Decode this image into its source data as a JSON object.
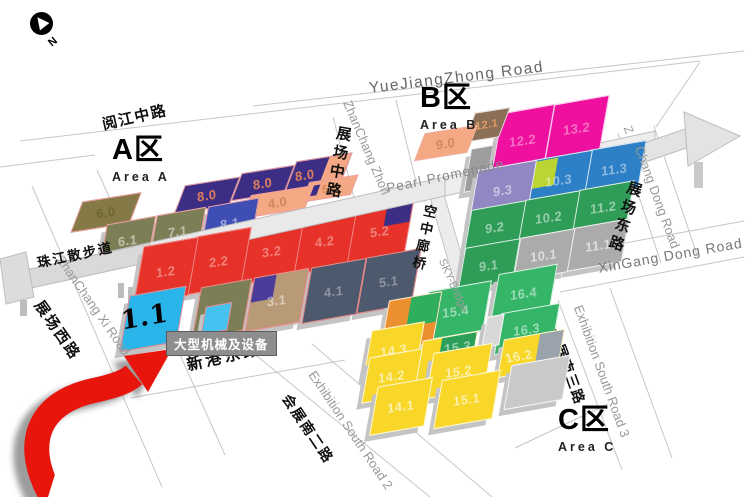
{
  "compass": {
    "label": "N"
  },
  "areas": {
    "a": {
      "title": "A区",
      "subtitle": "Area A"
    },
    "b": {
      "title": "B区",
      "subtitle": "Area B"
    },
    "c": {
      "title": "C区",
      "subtitle": "Area C"
    }
  },
  "callout": {
    "text": "大型机械及设备",
    "target_hall": "1.1"
  },
  "accent": {
    "arrow_color": "#e8150c",
    "arrow_shadow": "rgba(30,30,30,0.45)"
  },
  "roadLabels": [
    {
      "id": "yuejiangzhong-road-en",
      "text": "YueJiangZhong Road",
      "x": 368,
      "y": 80,
      "rot": -7,
      "cls": "en",
      "size": 15.5,
      "color": "#666",
      "ls": 1.5
    },
    {
      "id": "yuejiang-middle-road-cn",
      "text": "阅江中路",
      "x": 100,
      "y": 114,
      "rot": -13,
      "cls": "cn",
      "ls": 1.5
    },
    {
      "id": "zhanchang-zhong-road-en",
      "text": "ZhanChang Zhon",
      "x": 354,
      "y": 98,
      "rot": 67,
      "cls": "en",
      "size": 13
    },
    {
      "id": "zhanchang-zhong-road-cn",
      "text": "展场中路",
      "x": 334,
      "y": 124,
      "rot": 10,
      "cls": "cnv"
    },
    {
      "id": "pearl-promenade-en",
      "text": "Pearl Promenade",
      "x": 385,
      "y": 181,
      "rot": -12,
      "cls": "en",
      "size": 13.5,
      "color": "#888",
      "ls": 1
    },
    {
      "id": "zhujiang-promenade-cn",
      "text": "珠江散步道",
      "x": 35,
      "y": 252,
      "rot": -12,
      "cls": "cn",
      "size": 13.5,
      "ls": 2,
      "z": 330
    },
    {
      "id": "sky-corridor-cn",
      "text": "空中廊桥",
      "x": 420,
      "y": 202,
      "rot": 12,
      "cls": "cnv",
      "size": 13.5
    },
    {
      "id": "sky-bridge-en",
      "text": "SKY-Bridge",
      "x": 447,
      "y": 257,
      "rot": 66,
      "cls": "en",
      "size": 11,
      "color": "#9a9a9a"
    },
    {
      "id": "z-fragment",
      "text": "Z",
      "x": 634,
      "y": 124,
      "rot": 70,
      "cls": "en",
      "size": 12
    },
    {
      "id": "chang-dong-road-en",
      "text": "Chang Dong Road",
      "x": 646,
      "y": 144,
      "rot": 70,
      "cls": "en",
      "size": 13
    },
    {
      "id": "zhanchang-dong-road-cn",
      "text": "展场东路",
      "x": 626,
      "y": 178,
      "rot": 18,
      "cls": "cnv"
    },
    {
      "id": "xingang-dong-road-en",
      "text": "XinGang Dong Road",
      "x": 597,
      "y": 260,
      "rot": -10,
      "cls": "en",
      "size": 14,
      "color": "#777",
      "ls": 1
    },
    {
      "id": "xingang-dong-road-cn",
      "text": "新港东路",
      "x": 184,
      "y": 352,
      "rot": -13,
      "cls": "cn",
      "size": 16,
      "ls": 3
    },
    {
      "id": "exhibition-south-road-2-en",
      "text": "Exhibition South Road 2",
      "x": 318,
      "y": 368,
      "rot": 56,
      "cls": "en",
      "size": 13
    },
    {
      "id": "exhibition-south-road-2-cn",
      "text": "会展南二路",
      "x": 294,
      "y": 390,
      "rot": 56,
      "cls": "cn",
      "size": 14,
      "ls": 2
    },
    {
      "id": "exhibition-south-road-3-en",
      "text": "Exhibition South Road 3",
      "x": 585,
      "y": 303,
      "rot": 70,
      "cls": "en",
      "size": 13
    },
    {
      "id": "exhibition-south-road-3-cn",
      "text": "会展南三路",
      "x": 563,
      "y": 326,
      "rot": 70,
      "cls": "cn",
      "size": 14,
      "ls": 2
    },
    {
      "id": "zhanchang-xi-road-en",
      "text": "ZhanChang Xi Road",
      "x": 66,
      "y": 253,
      "rot": 55,
      "cls": "en",
      "size": 13
    },
    {
      "id": "zhanchang-xi-road-cn",
      "text": "展场西路",
      "x": 47,
      "y": 296,
      "rot": 55,
      "cls": "cn",
      "ls": 2
    }
  ],
  "halls": [
    {
      "label": "6.0",
      "x": 76,
      "y": 198,
      "w": 58,
      "h": 27,
      "flat": true,
      "color": "#857a47",
      "text": "#6e6535",
      "border": "#f0a0a0"
    },
    {
      "label": "8.0",
      "x": 179,
      "y": 182,
      "w": 54,
      "h": 25,
      "flat": true,
      "color": "#3d2e85",
      "text": "#df7e5e",
      "border": "#f0a0a0"
    },
    {
      "label": "8.0",
      "x": 236,
      "y": 170,
      "w": 52,
      "h": 24,
      "flat": true,
      "color": "#3d2e85",
      "text": "#df7e5e",
      "border": "#f0a0a0"
    },
    {
      "label": "8.0",
      "x": 290,
      "y": 158,
      "w": 55,
      "h": 27,
      "flat": true,
      "color": "#3d2e85",
      "text": "#df7e5e",
      "border": "#f0a0a0",
      "labelPos": "l",
      "inner": {
        "x": "60%",
        "y": "0%",
        "w": "40%",
        "h": "100%",
        "color": "#f4a984"
      }
    },
    {
      "label": "4.0",
      "x": 246,
      "y": 191,
      "w": 62,
      "h": 20,
      "flat": true,
      "color": "#f4a984",
      "text": "#d3875c",
      "border": "#f0a0a0"
    },
    {
      "label": "5.0",
      "x": 305,
      "y": 179,
      "w": 48,
      "h": 17,
      "flat": true,
      "color": "#f4a984",
      "text": "#d3875c",
      "border": "#f0a0a0",
      "labelSize": 11,
      "inner": {
        "x": "8%",
        "y": "18%",
        "w": "16%",
        "h": "58%",
        "color": "#3d2e85"
      }
    },
    {
      "label": "6.1",
      "x": 103,
      "y": 221,
      "w": 48,
      "h": 36,
      "color": "#7c7f55",
      "border": "#f0a0a0"
    },
    {
      "label": "7.1",
      "x": 153,
      "y": 212,
      "w": 48,
      "h": 36,
      "color": "#7c7f55",
      "border": "#f0a0a0"
    },
    {
      "label": "8.1",
      "x": 204,
      "y": 203,
      "w": 50,
      "h": 38,
      "color": "#3f4eb5",
      "border": "#f0a0a0"
    },
    {
      "label": "1.2",
      "x": 138,
      "y": 243,
      "w": 54,
      "h": 54,
      "color": "#e63229",
      "text": "rgba(255,255,255,0.38)",
      "border": "#f08a8a"
    },
    {
      "label": "2.2",
      "x": 191,
      "y": 233,
      "w": 54,
      "h": 54,
      "color": "#e63229",
      "text": "rgba(255,255,255,0.38)",
      "border": "#f08a8a"
    },
    {
      "label": "3.2",
      "x": 244,
      "y": 223,
      "w": 54,
      "h": 54,
      "color": "#e63229",
      "text": "rgba(255,255,255,0.38)",
      "border": "#f08a8a"
    },
    {
      "label": "4.2",
      "x": 297,
      "y": 213,
      "w": 54,
      "h": 54,
      "color": "#e63229",
      "text": "rgba(255,255,255,0.38)",
      "border": "#f08a8a"
    },
    {
      "label": "5.2",
      "x": 350,
      "y": 203,
      "w": 58,
      "h": 54,
      "color": "#e63229",
      "text": "rgba(255,255,255,0.38)",
      "border": "#f08a8a",
      "inner": {
        "x": "56%",
        "y": "0%",
        "w": "44%",
        "h": "42%",
        "color": "#3d2e85"
      }
    },
    {
      "label": "1.1",
      "x": 124,
      "y": 292,
      "w": 56,
      "h": 52,
      "color": "#2ab5ea",
      "border": "#f08a8a",
      "big": true
    },
    {
      "label": "",
      "x": 203,
      "y": 305,
      "w": 25,
      "h": 25,
      "color": "#45c2ef",
      "border": "#f08a8a"
    },
    {
      "label": "2.1",
      "x": 196,
      "y": 284,
      "w": 50,
      "h": 48,
      "color": "#7c7f55",
      "border": "#f08a8a"
    },
    {
      "label": "3.1",
      "x": 249,
      "y": 274,
      "w": 54,
      "h": 50,
      "color": "#b89b76",
      "border": "#f08a8a",
      "inner": {
        "x": "0%",
        "y": "0%",
        "w": "40%",
        "h": "46%",
        "color": "#4a3d99"
      }
    },
    {
      "label": "4.1",
      "x": 306,
      "y": 264,
      "w": 54,
      "h": 52,
      "color": "#4d5a6d",
      "text": "rgba(255,255,255,0.35)",
      "border": "#f08a8a"
    },
    {
      "label": "5.1",
      "x": 361,
      "y": 254,
      "w": 54,
      "h": 52,
      "color": "#4d5a6d",
      "text": "rgba(255,255,255,0.35)",
      "border": "#f08a8a"
    },
    {
      "label": "9.0",
      "x": 419,
      "y": 130,
      "w": 52,
      "h": 24,
      "flat": true,
      "color": "#f4a984",
      "text": "#d3875c",
      "border": "#f0b0a0"
    },
    {
      "label": "12.1",
      "x": 469,
      "y": 111,
      "w": 34,
      "h": 26,
      "flat": true,
      "color": "#8b6f56",
      "text": "#e09a62",
      "labelSize": 11
    },
    {
      "label": "",
      "x": 467,
      "y": 146,
      "w": 42,
      "h": 40,
      "color": "#9d9d9d",
      "z": 100
    },
    {
      "label": "12.2",
      "x": 496,
      "y": 110,
      "w": 52,
      "h": 58,
      "color": "#ef109f",
      "text": "rgba(255,255,255,0.4)"
    },
    {
      "label": "13.2",
      "x": 549,
      "y": 101,
      "w": 54,
      "h": 53,
      "color": "#ef109f",
      "text": "rgba(255,255,255,0.4)"
    },
    {
      "label": "9.3",
      "x": 473,
      "y": 166,
      "w": 58,
      "h": 47,
      "color": "#9187c2"
    },
    {
      "label": "10.3",
      "x": 529,
      "y": 156,
      "w": 58,
      "h": 46,
      "color": "#2e80c6",
      "text": "rgba(255,255,255,0.45)",
      "inner": {
        "x": "3%",
        "y": "3%",
        "w": "38%",
        "h": "55%",
        "color": "#bcd532"
      }
    },
    {
      "label": "11.3",
      "x": 585,
      "y": 146,
      "w": 56,
      "h": 44,
      "color": "#2e80c6",
      "text": "rgba(255,255,255,0.45)"
    },
    {
      "label": "9.2",
      "x": 467,
      "y": 206,
      "w": 54,
      "h": 41,
      "color": "#2f9c58"
    },
    {
      "label": "10.2",
      "x": 521,
      "y": 196,
      "w": 54,
      "h": 41,
      "color": "#2f9c58"
    },
    {
      "label": "11.2",
      "x": 575,
      "y": 186,
      "w": 54,
      "h": 41,
      "color": "#2f9c58"
    },
    {
      "label": "9.1",
      "x": 461,
      "y": 244,
      "w": 54,
      "h": 40,
      "color": "#2f9c58"
    },
    {
      "label": "10.1",
      "x": 516,
      "y": 234,
      "w": 54,
      "h": 40,
      "color": "#ababab",
      "text": "rgba(255,255,255,0.6)"
    },
    {
      "label": "11.1",
      "x": 570,
      "y": 224,
      "w": 54,
      "h": 40,
      "color": "#ababab",
      "text": "rgba(255,255,255,0.6)"
    },
    {
      "label": "14.4",
      "x": 384,
      "y": 297,
      "w": 52,
      "h": 48,
      "color": "#ec8f2e",
      "labelPos": "bl",
      "inner": {
        "x": "42%",
        "y": "0%",
        "w": "58%",
        "h": "58%",
        "color": "#2fae5e"
      }
    },
    {
      "label": "15.4",
      "x": 424,
      "y": 287,
      "w": 62,
      "h": 46,
      "color": "#35b568"
    },
    {
      "label": "16.4",
      "x": 494,
      "y": 270,
      "w": 58,
      "h": 44,
      "color": "#35b568"
    },
    {
      "label": "14.3",
      "x": 367,
      "y": 327,
      "w": 52,
      "h": 44,
      "color": "#f8d728",
      "text": "rgba(255,255,255,0.6)"
    },
    {
      "label": "15.3",
      "x": 418,
      "y": 337,
      "w": 54,
      "h": 45,
      "color": "#f8d728",
      "labelPos": "tr",
      "inner": {
        "x": "36%",
        "y": "0%",
        "w": "64%",
        "h": "52%",
        "color": "#2ca05a"
      }
    },
    {
      "label": "16.3",
      "x": 497,
      "y": 309,
      "w": 58,
      "h": 38,
      "color": "#35b568"
    },
    {
      "label": "",
      "x": 484,
      "y": 316,
      "w": 16,
      "h": 28,
      "color": "#d8d8d8",
      "z": 320
    },
    {
      "label": "16.2",
      "x": 500,
      "y": 335,
      "w": 60,
      "h": 35,
      "color": "#f8d728",
      "text": "rgba(255,255,255,0.6)",
      "labelPos": "l",
      "inner": {
        "x": "60%",
        "y": "0%",
        "w": "40%",
        "h": "100%",
        "color": "#9aa2ac"
      }
    },
    {
      "label": "14.2",
      "x": 365,
      "y": 354,
      "w": 52,
      "h": 42,
      "color": "#f8d728",
      "text": "rgba(255,255,255,0.6)"
    },
    {
      "label": "15.2",
      "x": 429,
      "y": 349,
      "w": 58,
      "h": 42,
      "color": "#f8d728",
      "text": "rgba(255,255,255,0.6)"
    },
    {
      "label": "14.1",
      "x": 373,
      "y": 383,
      "w": 54,
      "h": 45,
      "color": "#f8d728",
      "text": "rgba(255,255,255,0.6)"
    },
    {
      "label": "15.1",
      "x": 437,
      "y": 376,
      "w": 58,
      "h": 45,
      "color": "#f8d728",
      "text": "rgba(255,255,255,0.6)"
    },
    {
      "label": "",
      "x": 507,
      "y": 361,
      "w": 58,
      "h": 41,
      "color": "#c9c9c9"
    }
  ],
  "roadLines": [
    [
      253,
      106,
      744,
      51
    ],
    [
      20,
      141,
      700,
      61
    ],
    [
      0,
      167,
      95,
      155
    ],
    [
      700,
      62,
      656,
      127
    ],
    [
      618,
      133,
      661,
      263
    ],
    [
      654,
      126,
      697,
      255
    ],
    [
      560,
      255,
      744,
      221
    ],
    [
      560,
      292,
      744,
      257
    ],
    [
      128,
      352,
      320,
      320
    ],
    [
      130,
      398,
      345,
      360
    ],
    [
      252,
      352,
      430,
      497
    ],
    [
      312,
      344,
      492,
      497
    ],
    [
      558,
      300,
      622,
      470
    ],
    [
      610,
      288,
      672,
      458
    ],
    [
      515,
      448,
      608,
      404
    ],
    [
      97,
      170,
      225,
      455
    ],
    [
      32,
      186,
      162,
      487
    ],
    [
      333,
      117,
      358,
      213
    ],
    [
      396,
      100,
      420,
      198
    ]
  ]
}
